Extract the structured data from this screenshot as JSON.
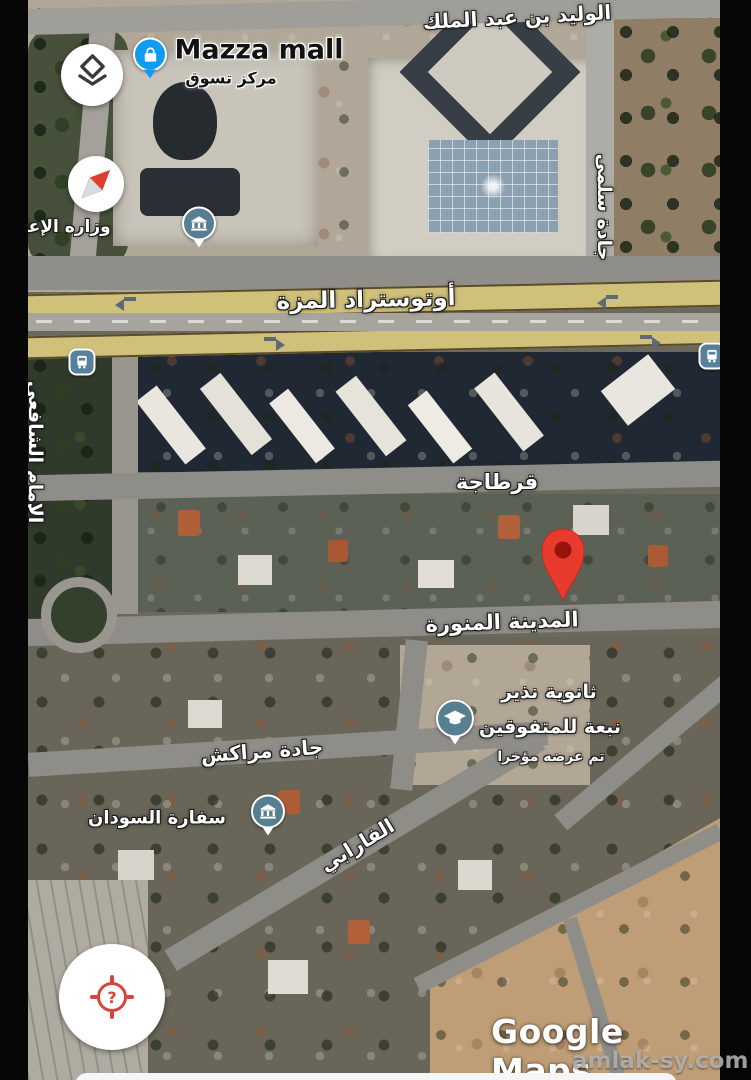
{
  "streets": {
    "walid_bin_abdulmalik": "الوليد بن عبد الملك",
    "jadat_salma": "جادة سلمى",
    "imam_shafii": "الإمام الشافعي",
    "mezzeh_highway": "أوتوستراد المزة",
    "qartaja": "قرطاجة",
    "madina_munawwara": "المدينة المنورة",
    "jadat_marrakech": "جادة مراكش",
    "farabi": "الفارابي"
  },
  "pois": {
    "mazza_mall": {
      "title": "Mazza mall",
      "subtitle": "مركز تسوق"
    },
    "ministry_of_information": {
      "label": "وزاره الإعلام"
    },
    "school": {
      "line1": "ثانوية نذير",
      "line2": "نبعة للمتفوقين",
      "note": "تم عرضه مؤخرا"
    },
    "sudan_embassy": {
      "label": "سفارة السودان"
    }
  },
  "controls": {
    "layers_button": {
      "icon": "layers"
    },
    "compass": {
      "icon": "compass-needle"
    },
    "my_location_button": {
      "glyph": "?"
    }
  },
  "watermarks": {
    "google_maps": "Google Maps",
    "site": "amlak-sy.com"
  },
  "colors": {
    "highway_yellow": "#cfc07a",
    "road_gray": "#8f8d88",
    "pin_red": "#e83a2d",
    "poi_blue": "#0f9bf2",
    "poi_slate": "#587e92",
    "target_red": "#d6453c"
  }
}
